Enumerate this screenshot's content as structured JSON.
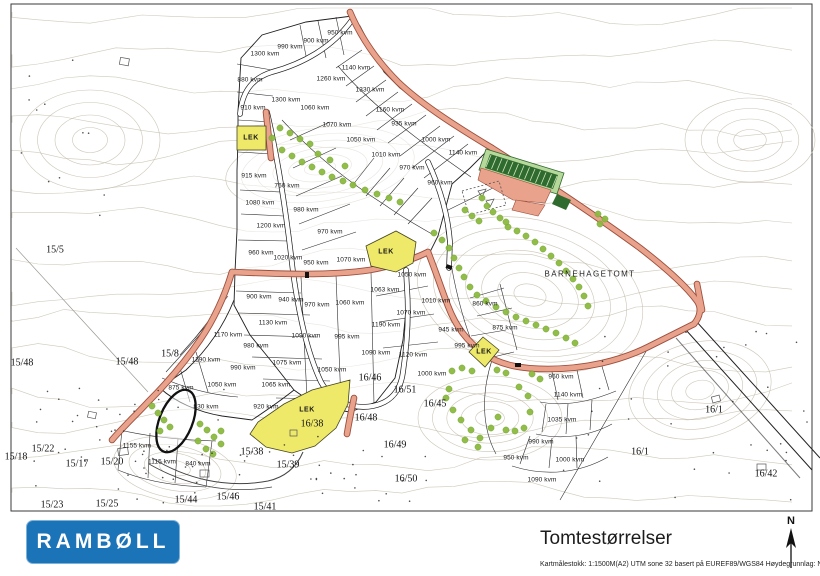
{
  "title_block": {
    "logo_text": "RAMBØLL",
    "title": "Tomtestørrelser",
    "meta": "Kartmålestokk: 1:1500M(A2)   UTM sone 32 basert på EUREF89/WGS84   Høydegrunnlag: NN2000",
    "north_label": "N"
  },
  "colors": {
    "road_fill": "#E9A28B",
    "road_casing": "#9C4F3D",
    "lek_yellow": "#EFE96A",
    "tree_green": "#8CBA3F",
    "logo_blue": "#1B73B8",
    "contour": "#C7BFAE"
  },
  "map": {
    "barnehage_label": "BARNEHAGETOMT",
    "barnehage_pos": {
      "x": 590,
      "y": 274
    },
    "lek_labels": [
      {
        "text": "LEK",
        "x": 251,
        "y": 138
      },
      {
        "text": "LEK",
        "x": 386,
        "y": 252
      },
      {
        "text": "LEK",
        "x": 484,
        "y": 352
      },
      {
        "text": "LEK",
        "x": 307,
        "y": 410
      }
    ],
    "plot_size_labels": [
      {
        "text": "950 kvm",
        "x": 340,
        "y": 33
      },
      {
        "text": "900 kvm",
        "x": 316,
        "y": 41
      },
      {
        "text": "990 kvm",
        "x": 290,
        "y": 47
      },
      {
        "text": "1300 kvm",
        "x": 265,
        "y": 54
      },
      {
        "text": "1140 kvm",
        "x": 356,
        "y": 68
      },
      {
        "text": "1260 kvm",
        "x": 331,
        "y": 79
      },
      {
        "text": "880 kvm",
        "x": 250,
        "y": 80
      },
      {
        "text": "1330 kvm",
        "x": 370,
        "y": 90
      },
      {
        "text": "1300 kvm",
        "x": 286,
        "y": 100
      },
      {
        "text": "1060 kvm",
        "x": 315,
        "y": 108
      },
      {
        "text": "910 kvm",
        "x": 253,
        "y": 108
      },
      {
        "text": "1160 kvm",
        "x": 390,
        "y": 110
      },
      {
        "text": "935 kvm",
        "x": 404,
        "y": 124
      },
      {
        "text": "1070 kvm",
        "x": 337,
        "y": 125
      },
      {
        "text": "1050 kvm",
        "x": 361,
        "y": 140
      },
      {
        "text": "1000 kvm",
        "x": 436,
        "y": 140
      },
      {
        "text": "1140 kvm",
        "x": 463,
        "y": 153
      },
      {
        "text": "1010 kvm",
        "x": 386,
        "y": 155
      },
      {
        "text": "970 kvm",
        "x": 412,
        "y": 168
      },
      {
        "text": "915 kvm",
        "x": 254,
        "y": 176
      },
      {
        "text": "960 kvm",
        "x": 440,
        "y": 183
      },
      {
        "text": "760 kvm",
        "x": 287,
        "y": 186
      },
      {
        "text": "1080 kvm",
        "x": 260,
        "y": 203
      },
      {
        "text": "980 kvm",
        "x": 306,
        "y": 210
      },
      {
        "text": "1200 kvm",
        "x": 271,
        "y": 226
      },
      {
        "text": "970 kvm",
        "x": 330,
        "y": 232
      },
      {
        "text": "960 kvm",
        "x": 261,
        "y": 253
      },
      {
        "text": "1020 kvm",
        "x": 288,
        "y": 258
      },
      {
        "text": "1070 kvm",
        "x": 351,
        "y": 260
      },
      {
        "text": "950 kvm",
        "x": 316,
        "y": 263
      },
      {
        "text": "1050 kvm",
        "x": 412,
        "y": 275
      },
      {
        "text": "1063 kvm",
        "x": 385,
        "y": 290
      },
      {
        "text": "900 kvm",
        "x": 259,
        "y": 297
      },
      {
        "text": "940 kvm",
        "x": 291,
        "y": 300
      },
      {
        "text": "1060 kvm",
        "x": 350,
        "y": 303
      },
      {
        "text": "1010 kvm",
        "x": 436,
        "y": 301
      },
      {
        "text": "860 kvm",
        "x": 485,
        "y": 304
      },
      {
        "text": "970 kvm",
        "x": 317,
        "y": 305
      },
      {
        "text": "1070 kvm",
        "x": 411,
        "y": 313
      },
      {
        "text": "1130 kvm",
        "x": 273,
        "y": 323
      },
      {
        "text": "1190 kvm",
        "x": 386,
        "y": 325
      },
      {
        "text": "945 kvm",
        "x": 451,
        "y": 330
      },
      {
        "text": "875 kvm",
        "x": 505,
        "y": 328
      },
      {
        "text": "1170 kvm",
        "x": 228,
        "y": 335
      },
      {
        "text": "1090 kvm",
        "x": 306,
        "y": 336
      },
      {
        "text": "995 kvm",
        "x": 347,
        "y": 337
      },
      {
        "text": "995 kvm",
        "x": 467,
        "y": 346
      },
      {
        "text": "980 kvm",
        "x": 256,
        "y": 346
      },
      {
        "text": "1090 kvm",
        "x": 376,
        "y": 353
      },
      {
        "text": "1120 kvm",
        "x": 413,
        "y": 355
      },
      {
        "text": "1190 kvm",
        "x": 206,
        "y": 360
      },
      {
        "text": "1075 kvm",
        "x": 287,
        "y": 363
      },
      {
        "text": "990 kvm",
        "x": 243,
        "y": 368
      },
      {
        "text": "1050 kvm",
        "x": 332,
        "y": 370
      },
      {
        "text": "1000 kvm",
        "x": 432,
        "y": 374
      },
      {
        "text": "960 kvm",
        "x": 561,
        "y": 377
      },
      {
        "text": "1050 kvm",
        "x": 222,
        "y": 385
      },
      {
        "text": "1065 kvm",
        "x": 276,
        "y": 385
      },
      {
        "text": "875 kvm",
        "x": 181,
        "y": 388
      },
      {
        "text": "1140 kvm",
        "x": 568,
        "y": 395
      },
      {
        "text": "830 kvm",
        "x": 206,
        "y": 407
      },
      {
        "text": "920 kvm",
        "x": 266,
        "y": 407
      },
      {
        "text": "1035 kvm",
        "x": 562,
        "y": 420
      },
      {
        "text": "990 kvm",
        "x": 541,
        "y": 442
      },
      {
        "text": "1155 kvm",
        "x": 137,
        "y": 446
      },
      {
        "text": "950 kvm",
        "x": 516,
        "y": 458
      },
      {
        "text": "1000 kvm",
        "x": 570,
        "y": 460
      },
      {
        "text": "1115 kvm",
        "x": 162,
        "y": 462
      },
      {
        "text": "840 kvm",
        "x": 198,
        "y": 464
      },
      {
        "text": "1090 kvm",
        "x": 542,
        "y": 480
      }
    ],
    "parcel_labels": [
      {
        "text": "15/5",
        "x": 55,
        "y": 250
      },
      {
        "text": "15/48",
        "x": 22,
        "y": 363
      },
      {
        "text": "15/8",
        "x": 170,
        "y": 354
      },
      {
        "text": "15/48",
        "x": 127,
        "y": 362
      },
      {
        "text": "15/18",
        "x": 16,
        "y": 457
      },
      {
        "text": "15/22",
        "x": 43,
        "y": 449
      },
      {
        "text": "15/17",
        "x": 77,
        "y": 464
      },
      {
        "text": "15/20",
        "x": 112,
        "y": 462
      },
      {
        "text": "15/23",
        "x": 52,
        "y": 505
      },
      {
        "text": "15/25",
        "x": 107,
        "y": 504
      },
      {
        "text": "15/44",
        "x": 186,
        "y": 500
      },
      {
        "text": "15/46",
        "x": 228,
        "y": 497
      },
      {
        "text": "15/41",
        "x": 265,
        "y": 507
      },
      {
        "text": "15/38",
        "x": 252,
        "y": 452
      },
      {
        "text": "15/39",
        "x": 288,
        "y": 465
      },
      {
        "text": "16/46",
        "x": 370,
        "y": 378
      },
      {
        "text": "16/51",
        "x": 405,
        "y": 390
      },
      {
        "text": "16/45",
        "x": 435,
        "y": 404
      },
      {
        "text": "16/48",
        "x": 366,
        "y": 418
      },
      {
        "text": "16/49",
        "x": 395,
        "y": 445
      },
      {
        "text": "16/50",
        "x": 406,
        "y": 479
      },
      {
        "text": "16/38",
        "x": 312,
        "y": 424
      },
      {
        "text": "16/1",
        "x": 714,
        "y": 410
      },
      {
        "text": "16/1",
        "x": 640,
        "y": 452
      },
      {
        "text": "16/42",
        "x": 766,
        "y": 474
      }
    ],
    "trees": [
      [
        280,
        128
      ],
      [
        290,
        133
      ],
      [
        300,
        139
      ],
      [
        310,
        144
      ],
      [
        282,
        150
      ],
      [
        292,
        156
      ],
      [
        302,
        162
      ],
      [
        312,
        167
      ],
      [
        322,
        172
      ],
      [
        332,
        177
      ],
      [
        343,
        181
      ],
      [
        353,
        185
      ],
      [
        365,
        190
      ],
      [
        377,
        194
      ],
      [
        389,
        198
      ],
      [
        400,
        202
      ],
      [
        272,
        138
      ],
      [
        318,
        154
      ],
      [
        330,
        160
      ],
      [
        345,
        166
      ],
      [
        434,
        233
      ],
      [
        442,
        240
      ],
      [
        449,
        248
      ],
      [
        454,
        258
      ],
      [
        459,
        268
      ],
      [
        464,
        277
      ],
      [
        470,
        287
      ],
      [
        477,
        295
      ],
      [
        486,
        301
      ],
      [
        496,
        307
      ],
      [
        506,
        312
      ],
      [
        516,
        317
      ],
      [
        526,
        321
      ],
      [
        536,
        325
      ],
      [
        546,
        329
      ],
      [
        556,
        333
      ],
      [
        566,
        338
      ],
      [
        575,
        343
      ],
      [
        508,
        227
      ],
      [
        517,
        231
      ],
      [
        526,
        236
      ],
      [
        535,
        242
      ],
      [
        543,
        249
      ],
      [
        551,
        256
      ],
      [
        559,
        263
      ],
      [
        566,
        271
      ],
      [
        573,
        279
      ],
      [
        579,
        287
      ],
      [
        584,
        296
      ],
      [
        588,
        306
      ],
      [
        452,
        371
      ],
      [
        462,
        368
      ],
      [
        472,
        371
      ],
      [
        497,
        370
      ],
      [
        506,
        373
      ],
      [
        532,
        374
      ],
      [
        540,
        379
      ],
      [
        449,
        389
      ],
      [
        446,
        398
      ],
      [
        453,
        410
      ],
      [
        461,
        420
      ],
      [
        471,
        430
      ],
      [
        480,
        438
      ],
      [
        491,
        428
      ],
      [
        498,
        417
      ],
      [
        506,
        430
      ],
      [
        515,
        431
      ],
      [
        524,
        428
      ],
      [
        530,
        412
      ],
      [
        528,
        396
      ],
      [
        519,
        387
      ],
      [
        465,
        440
      ],
      [
        478,
        447
      ],
      [
        152,
        406
      ],
      [
        158,
        413
      ],
      [
        164,
        420
      ],
      [
        170,
        427
      ],
      [
        160,
        431
      ],
      [
        200,
        424
      ],
      [
        207,
        430
      ],
      [
        214,
        437
      ],
      [
        221,
        444
      ],
      [
        206,
        449
      ],
      [
        213,
        454
      ],
      [
        198,
        441
      ],
      [
        221,
        431
      ],
      [
        465,
        210
      ],
      [
        472,
        216
      ],
      [
        479,
        221
      ],
      [
        487,
        206
      ],
      [
        493,
        212
      ],
      [
        500,
        218
      ],
      [
        482,
        198
      ],
      [
        506,
        222
      ],
      [
        598,
        214
      ],
      [
        605,
        219
      ],
      [
        600,
        224
      ]
    ]
  }
}
